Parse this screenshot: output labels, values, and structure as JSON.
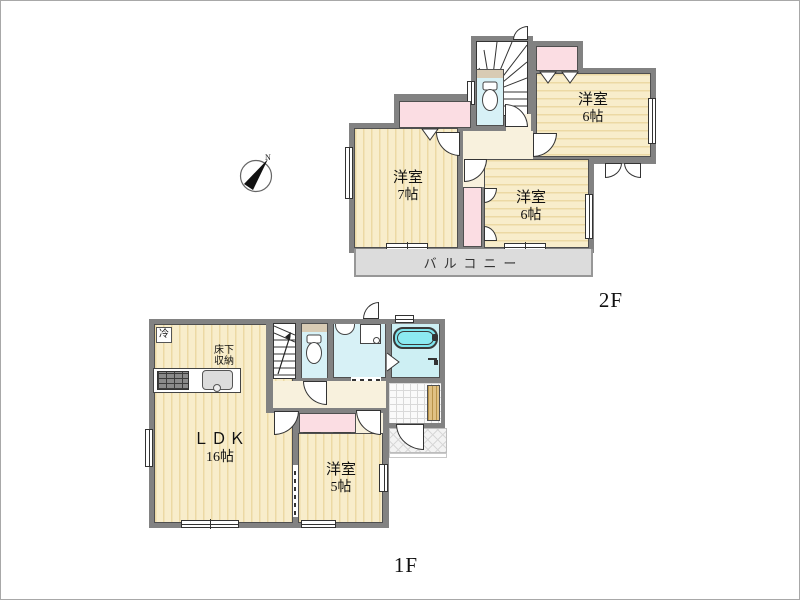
{
  "compass": {
    "north_label": "N"
  },
  "floor2": {
    "label": "2F",
    "room_nw": {
      "name_l1": "洋室",
      "size_l2": "7帖"
    },
    "room_ne": {
      "name_l1": "洋室",
      "size_l2": "6帖"
    },
    "room_s": {
      "name_l1": "洋室",
      "size_l2": "6帖"
    },
    "balcony": "バルコニー"
  },
  "floor1": {
    "label": "1F",
    "ldk": {
      "name_l1": "ＬＤＫ",
      "size_l2": "16帖"
    },
    "room_se": {
      "name_l1": "洋室",
      "size_l2": "5帖"
    },
    "underfloor_storage": {
      "l1": "床下",
      "l2": "収納"
    },
    "refrigerator": "冷"
  },
  "colors": {
    "wall": "#828282",
    "floor_stripe_base": "#f8edcb",
    "floor_stripe_line": "#ecd9a4",
    "closet_pink": "#fbdde3",
    "water_blue": "#d7f1f6",
    "bathtub_cyan": "#7ee6ee",
    "hall_cream": "#f8f1dd",
    "balcony_gray": "#dcdcdc",
    "genkan_wood": "#e0c184"
  }
}
